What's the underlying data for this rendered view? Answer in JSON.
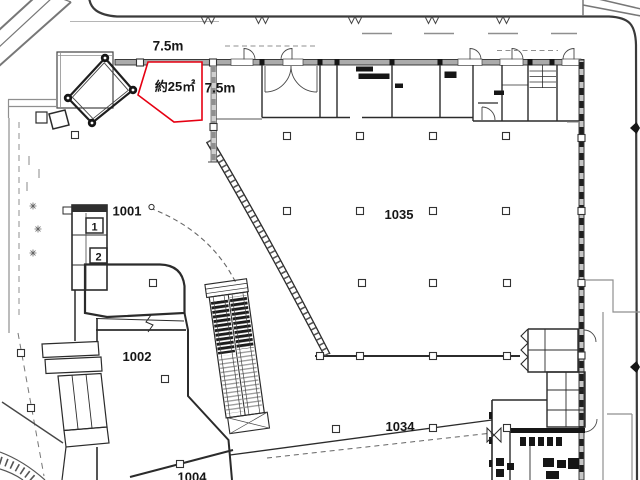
{
  "plan": {
    "type": "architectural-floor-plan",
    "highlight": {
      "area_label": "約25㎡",
      "width_label": "7.5m",
      "depth_label": "7.5m",
      "color": "#e60012"
    },
    "rooms": [
      {
        "number": "1001"
      },
      {
        "number": "1002"
      },
      {
        "number": "1004"
      },
      {
        "number": "1034"
      },
      {
        "number": "1035"
      }
    ],
    "markers": [
      {
        "label": "1"
      },
      {
        "label": "2"
      }
    ],
    "colors": {
      "wall": "#2b2b2b",
      "road": "#3a3a3a",
      "gray": "#8f8f8f",
      "background": "#ffffff"
    }
  }
}
